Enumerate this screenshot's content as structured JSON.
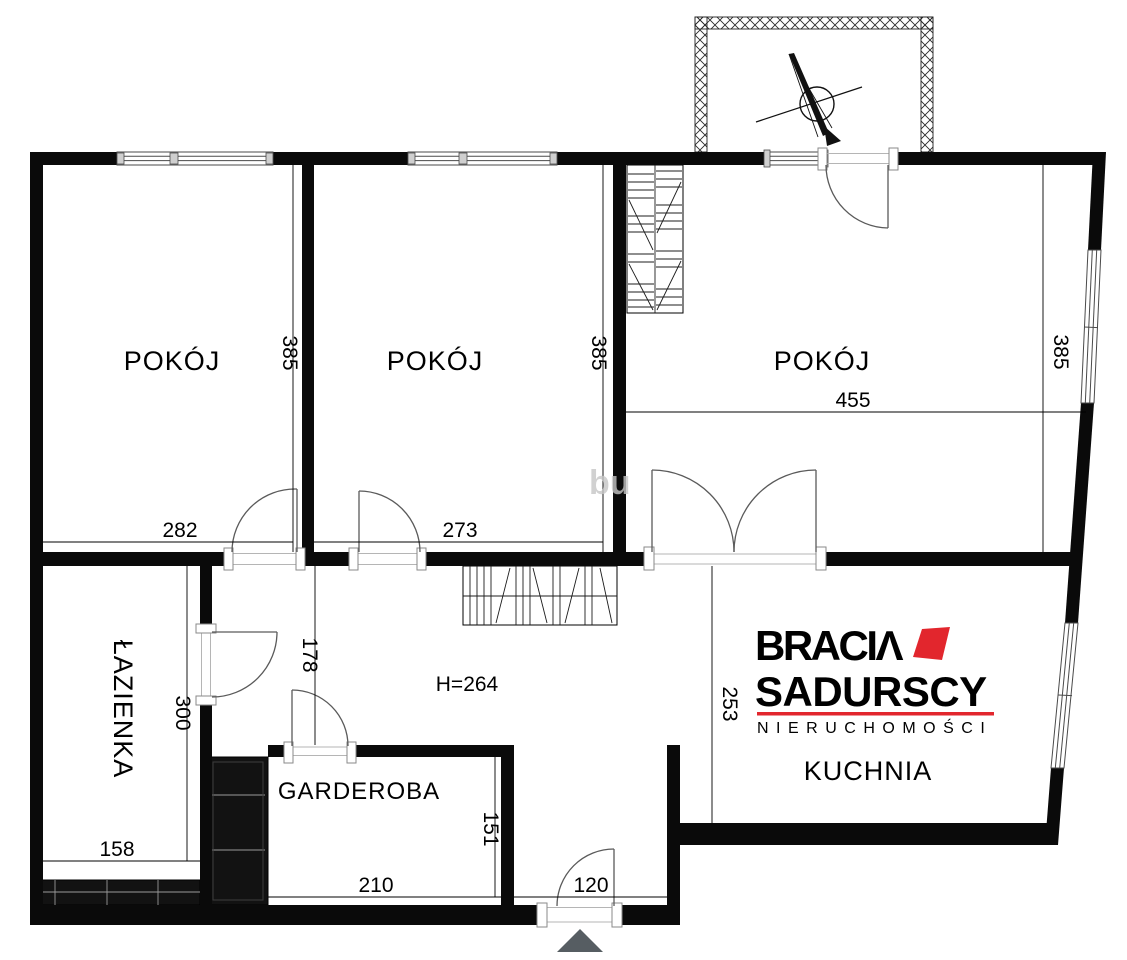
{
  "floorplan": {
    "rooms": {
      "room_top_left": "POKÓJ",
      "room_top_middle": "POKÓJ",
      "room_top_right": "POKÓJ",
      "bathroom": "ŁAZIENKA",
      "closet": "GARDEROBA",
      "kitchen": "KUCHNIA"
    },
    "ceiling_height": "H=264",
    "dimensions": {
      "room_top_left_width": "282",
      "room_top_left_depth": "385",
      "room_top_middle_width": "273",
      "room_top_middle_depth": "385",
      "room_top_right_width": "455",
      "room_top_right_depth": "385",
      "bathroom_width": "158",
      "bathroom_depth": "300",
      "hallway_depth": "178",
      "closet_width": "210",
      "closet_depth": "151",
      "entry_width": "120",
      "kitchen_depth": "253"
    }
  },
  "branding": {
    "brand_line1": "BRACIΛ",
    "brand_line2": "SADURSCY",
    "brand_line3": "NIERUCHOMOŚCI",
    "accent_color": "#e2262d",
    "text_color": "#26242f"
  },
  "watermark": "bu",
  "colors": {
    "wall": "#0a0a0a",
    "entrance_marker": "#565d62"
  }
}
